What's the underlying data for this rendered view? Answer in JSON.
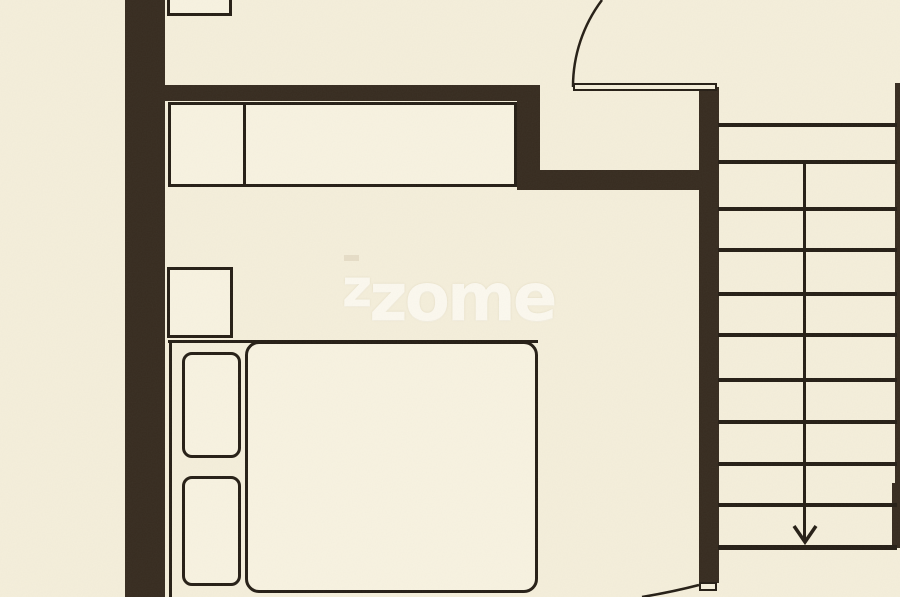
{
  "meta": {
    "type": "architectural-floor-plan",
    "view": "partial upper-floor plan: bedroom with wardrobe and double bed, hallway with two swing doors, staircase going down"
  },
  "watermark": {
    "text": "zzome",
    "first": "z",
    "rest": "zome"
  },
  "palette": {
    "bg": "#f4eeda",
    "wall": "#372c20",
    "line": "#261f16",
    "fill": "#f7f2e0",
    "wm": "#fdfaf2"
  },
  "plan": {
    "walls": [
      "left-exterior-wall",
      "bedroom-top-wall",
      "wall-jog",
      "hallway-partition-wall",
      "stairwell-left-wall",
      "stairwell-right-edge",
      "stairwell-right-wall-segment"
    ],
    "furniture": [
      {
        "name": "closet-cut-at-top-edge"
      },
      {
        "name": "wardrobe",
        "sections": 2
      },
      {
        "name": "nightstand"
      },
      {
        "name": "double-bed",
        "parts": [
          "frame",
          "duvet",
          "pillow",
          "pillow"
        ]
      }
    ],
    "doors": [
      {
        "name": "hallway-door",
        "state": "open",
        "swing": "upward-arc"
      },
      {
        "name": "bottom-door",
        "state": "partially-visible",
        "swing": "arc-at-bottom-edge"
      }
    ],
    "stairs": {
      "direction": "down",
      "tread_y": [
        123,
        160,
        207,
        248,
        292,
        333,
        378,
        420,
        462,
        503,
        545
      ],
      "left_x": 718,
      "right_x": 897,
      "arrow_x": 805
    }
  }
}
